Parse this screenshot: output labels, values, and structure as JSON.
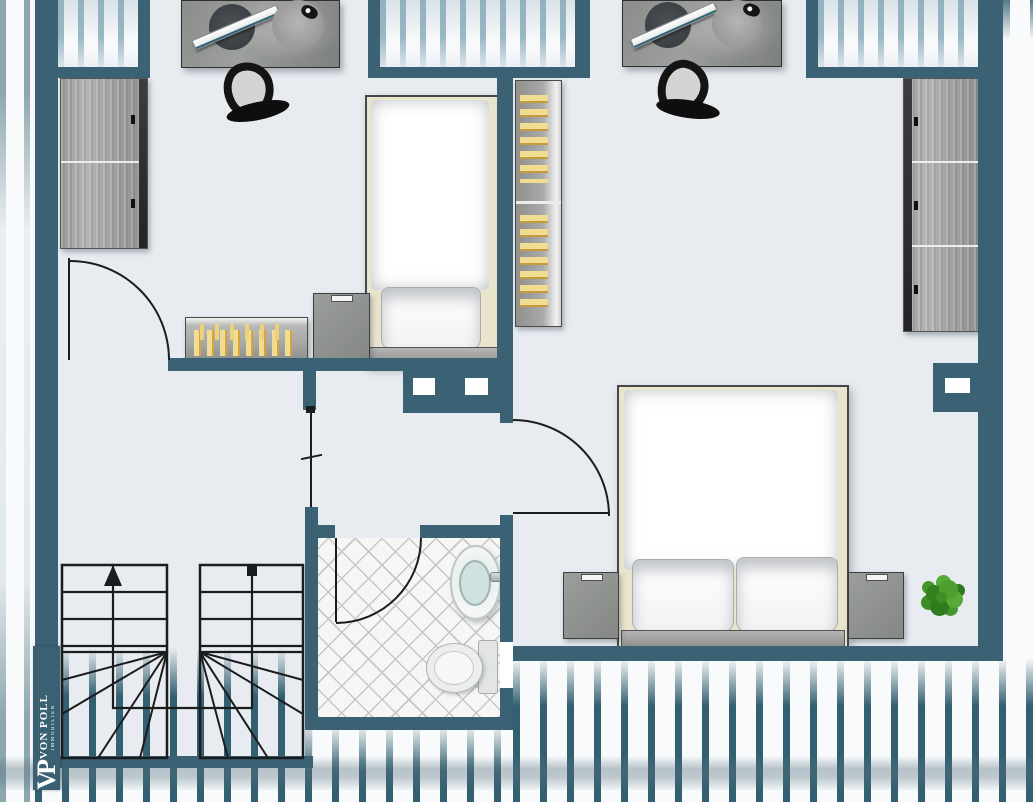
{
  "brand": {
    "monogram": "VP",
    "name": "VON POLL",
    "subtitle": "IMMOBILIEN"
  },
  "palette": {
    "wall": "#3b6274",
    "floor": "#e8ecf1",
    "roof_hatch": "#336070",
    "window_stripe": "#8aacbc",
    "furniture_gray": "#9c9e9c",
    "book_yellow": "#f0dc92",
    "book_orange": "#d9a33c",
    "bed_linen": "#ffffff",
    "bed_sheet": "#e9e5cc",
    "tile_line": "#c7c7c5",
    "basin": "#cfe2e0",
    "plant_green": "#45962c",
    "linework": "#1b1c1e"
  },
  "plan": {
    "type": "attic floor plan",
    "roof_window_bays": 3,
    "rooms": [
      {
        "id": "bedroom-left",
        "items": [
          "desk",
          "monitor",
          "desk-lamp",
          "office-chair",
          "wardrobe",
          "single-bed",
          "pillow",
          "nightstand",
          "sideboard-with-books",
          "hinged-door"
        ]
      },
      {
        "id": "bedroom-right",
        "items": [
          "desk",
          "monitor",
          "desk-lamp",
          "office-chair",
          "bookcase",
          "wardrobe",
          "double-bed",
          "two-pillows",
          "nightstand-left",
          "nightstand-right",
          "potted-plant",
          "hinged-door"
        ]
      },
      {
        "id": "bathroom",
        "items": [
          "washbasin",
          "faucet",
          "toilet",
          "tiled-floor",
          "hinged-door"
        ]
      },
      {
        "id": "hallway-landing",
        "items": [
          "u-shaped-staircase",
          "up-arrow",
          "start-dot",
          "railing-line"
        ]
      }
    ],
    "stairs": {
      "flights": 2,
      "direction": "up"
    }
  }
}
